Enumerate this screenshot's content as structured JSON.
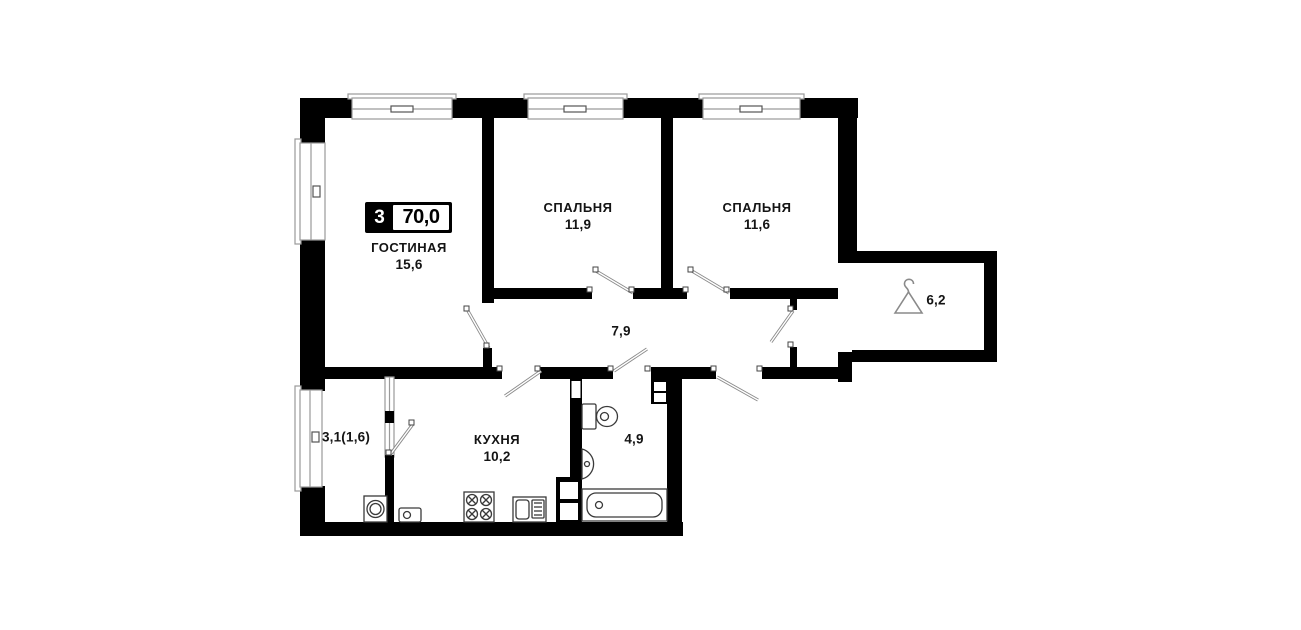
{
  "floorplan": {
    "badge": {
      "rooms": "3",
      "total_area": "70,0"
    },
    "rooms": [
      {
        "id": "living",
        "name": "ГОСТИНАЯ",
        "area": "15,6"
      },
      {
        "id": "bedroom1",
        "name": "СПАЛЬНЯ",
        "area": "11,9"
      },
      {
        "id": "bedroom2",
        "name": "СПАЛЬНЯ",
        "area": "11,6"
      },
      {
        "id": "kitchen",
        "name": "КУХНЯ",
        "area": "10,2"
      },
      {
        "id": "hallway",
        "name": "",
        "area": "7,9"
      },
      {
        "id": "bathroom",
        "name": "",
        "area": "4,9"
      },
      {
        "id": "balcony",
        "name": "",
        "area": "3,1(1,6)"
      },
      {
        "id": "wardrobe",
        "name": "",
        "area": "6,2"
      }
    ],
    "icons": {
      "wardrobe": "hanger-icon"
    },
    "fixtures": [
      "bathtub",
      "toilet",
      "washbasin",
      "kitchen-sink",
      "stove",
      "washing-machine",
      "vent-shaft",
      "windows",
      "door-leaves"
    ],
    "colors": {
      "wall": "#000000",
      "background": "#ffffff",
      "fixture_stroke": "#3a3a3a",
      "frame_stroke": "#9a9a9a",
      "text": "#141414"
    }
  }
}
